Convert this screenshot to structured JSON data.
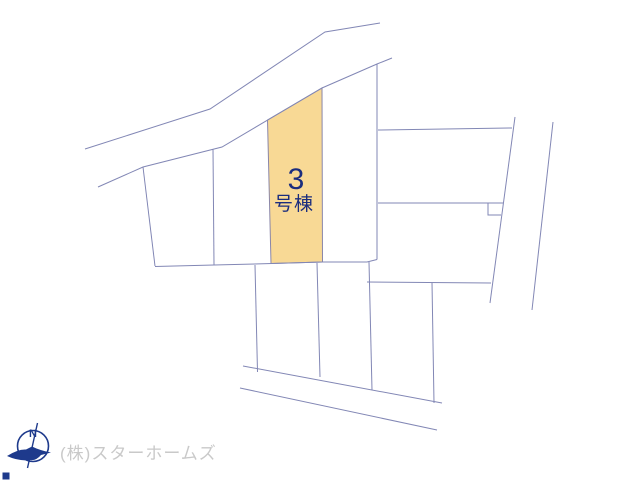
{
  "map": {
    "background_color": "#ffffff",
    "line_color": "#8287b5",
    "highlight_lot": {
      "label_number": "3",
      "label_suffix": "号棟",
      "fill": "#f8d995",
      "stroke": "#8a86a8",
      "text_color": "#1b2d7e",
      "points": [
        [
          267.5,
          120
        ],
        [
          322,
          88
        ],
        [
          322.5,
          262
        ],
        [
          271,
          263.5
        ]
      ]
    },
    "lines": [
      {
        "name": "top-road-upper-edge",
        "points": [
          [
            85,
            149
          ],
          [
            210,
            109
          ],
          [
            325,
            32
          ],
          [
            380,
            23
          ]
        ]
      },
      {
        "name": "lot-row-top-boundary",
        "points": [
          [
            98,
            187
          ],
          [
            143,
            167
          ],
          [
            222,
            147
          ],
          [
            322,
            88
          ],
          [
            377,
            64
          ],
          [
            392,
            58
          ]
        ]
      },
      {
        "name": "left-lot-left-edge",
        "points": [
          [
            143,
            167
          ],
          [
            155,
            266
          ]
        ]
      },
      {
        "name": "lot-row-bottom-boundary",
        "points": [
          [
            155,
            266.5
          ],
          [
            214,
            265
          ],
          [
            272,
            263.5
          ],
          [
            322.5,
            262
          ],
          [
            367,
            262
          ],
          [
            377,
            259.5
          ]
        ]
      },
      {
        "name": "lot-divider-1",
        "points": [
          [
            213,
            149
          ],
          [
            214,
            265
          ]
        ]
      },
      {
        "name": "lot-divider-right-of-3",
        "points": [
          [
            377,
            64
          ],
          [
            377,
            259.5
          ]
        ]
      },
      {
        "name": "right-block-h-line-upper",
        "points": [
          [
            378,
            130
          ],
          [
            512,
            128
          ]
        ]
      },
      {
        "name": "right-block-h-line-lower",
        "points": [
          [
            378,
            203
          ],
          [
            503,
            203
          ]
        ]
      },
      {
        "name": "right-block-notch",
        "points": [
          [
            488,
            203
          ],
          [
            488,
            215
          ],
          [
            501,
            215
          ]
        ]
      },
      {
        "name": "right-road-edge-inner",
        "points": [
          [
            515,
            117
          ],
          [
            490,
            303
          ]
        ]
      },
      {
        "name": "right-road-edge-outer",
        "points": [
          [
            553,
            122
          ],
          [
            532,
            310
          ]
        ]
      },
      {
        "name": "lower-row-divider-1",
        "points": [
          [
            255,
            265
          ],
          [
            257.5,
            372
          ]
        ]
      },
      {
        "name": "lower-row-divider-2",
        "points": [
          [
            317,
            263
          ],
          [
            320,
            377
          ]
        ]
      },
      {
        "name": "lower-row-divider-3",
        "points": [
          [
            369,
            262
          ],
          [
            372,
            390
          ]
        ]
      },
      {
        "name": "lower-row-h-line",
        "points": [
          [
            367,
            282
          ],
          [
            491,
            283
          ]
        ]
      },
      {
        "name": "lower-row-divider-4",
        "points": [
          [
            432,
            282.5
          ],
          [
            434,
            403
          ]
        ]
      },
      {
        "name": "bottom-road-upper-edge",
        "points": [
          [
            243,
            366
          ],
          [
            442,
            403
          ]
        ]
      },
      {
        "name": "bottom-road-lower-edge",
        "points": [
          [
            240,
            388
          ],
          [
            437,
            430
          ]
        ]
      }
    ]
  },
  "compass": {
    "letter": "N",
    "color": "#1e3a8c"
  },
  "company": {
    "name": "(株)スターホームズ",
    "color": "#c9c9c9"
  }
}
